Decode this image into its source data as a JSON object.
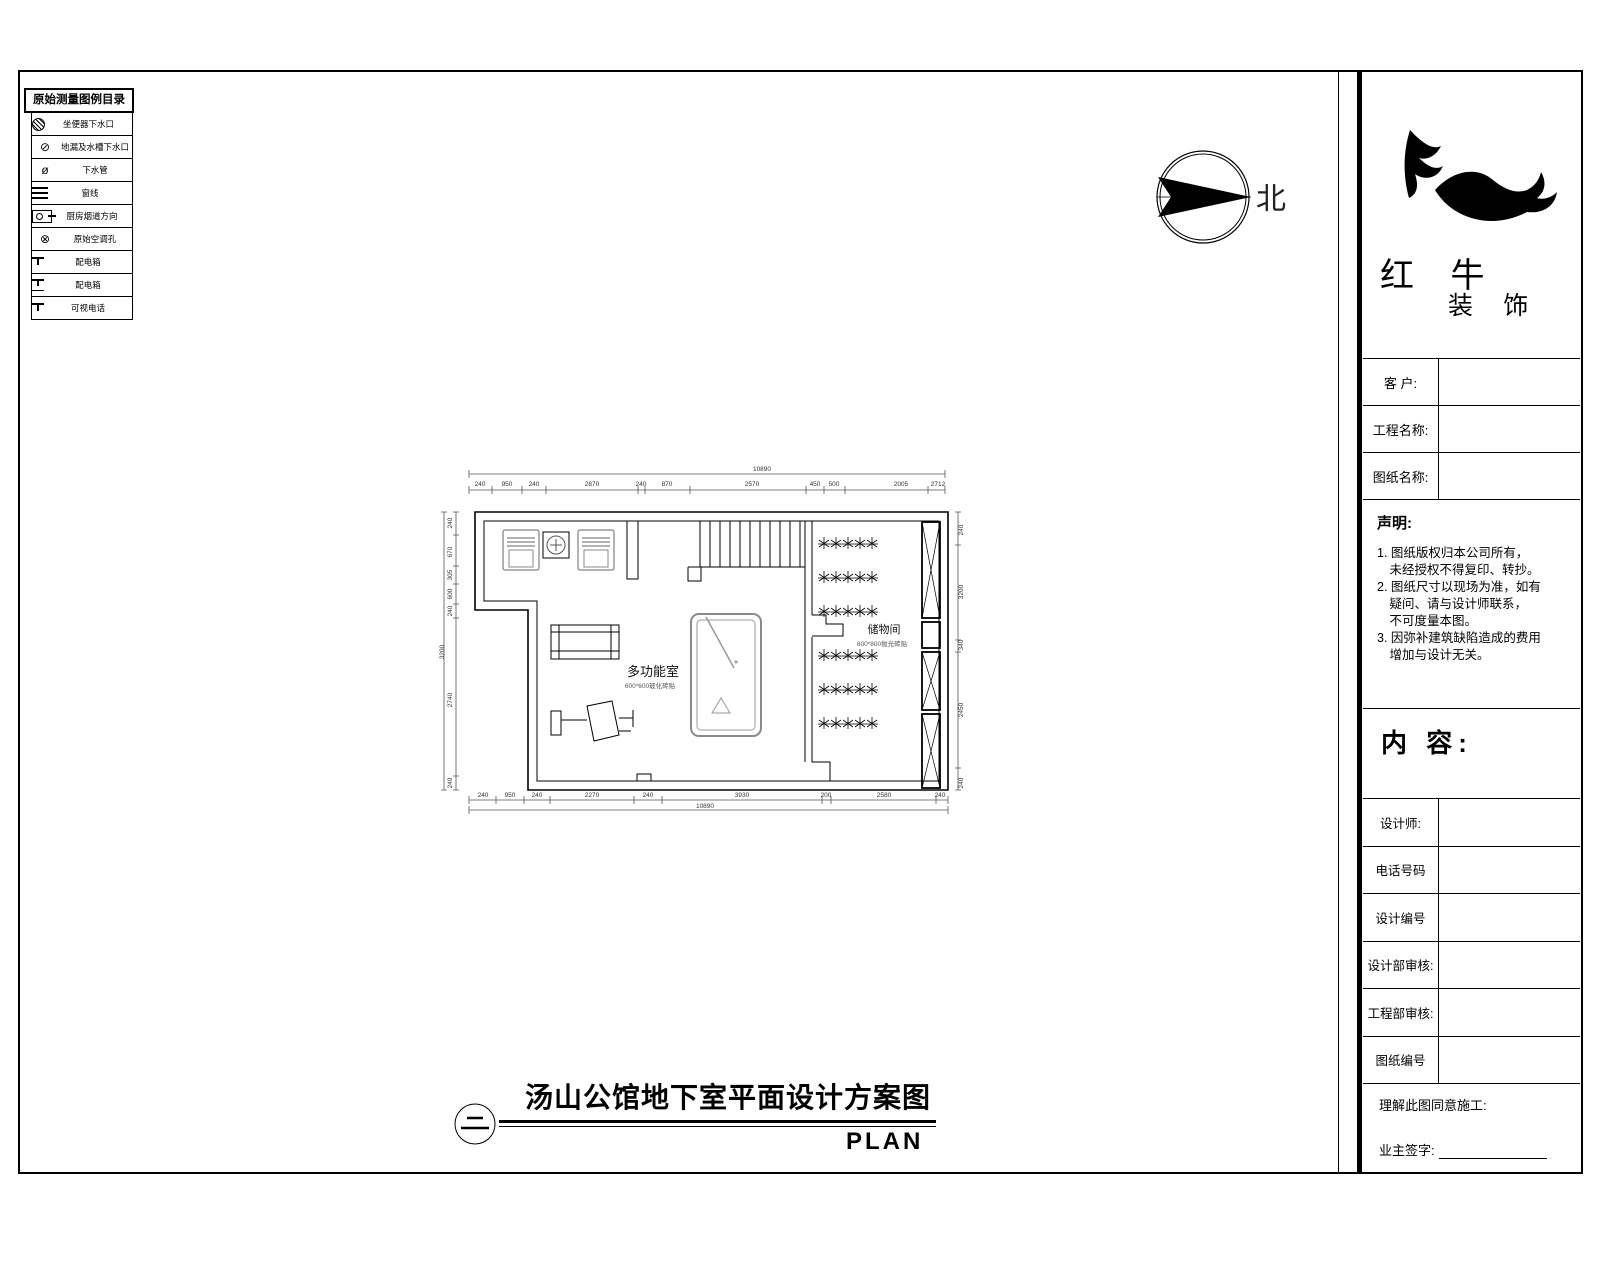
{
  "legend": {
    "title": "原始测量图例目录",
    "items": [
      {
        "icon": "toilet-drain-icon",
        "cls": "ic-circle-hatch",
        "glyph": "",
        "label": "坐便器下水口"
      },
      {
        "icon": "floor-drain-icon",
        "cls": "",
        "glyph": "⊘",
        "label": "地漏及水槽下水口"
      },
      {
        "icon": "drain-pipe-icon",
        "cls": "",
        "glyph": "ø",
        "label": "下水管"
      },
      {
        "icon": "window-line-icon",
        "cls": "ic-lines",
        "glyph": "",
        "label": "窗线"
      },
      {
        "icon": "kitchen-flue-icon",
        "cls": "ic-flue",
        "glyph": "",
        "label": "厨房烟道方向"
      },
      {
        "icon": "ac-hole-icon",
        "cls": "",
        "glyph": "⊗",
        "label": "原始空调孔"
      },
      {
        "icon": "power-box-icon",
        "cls": "ic-t",
        "glyph": "",
        "label": "配电箱"
      },
      {
        "icon": "power-box2-icon",
        "cls": "ic-t2",
        "glyph": "",
        "label": "配电箱"
      },
      {
        "icon": "video-phone-icon",
        "cls": "ic-t",
        "glyph": "",
        "label": "可视电话"
      }
    ]
  },
  "north": {
    "label": "北"
  },
  "brand": {
    "name_large": "红 牛",
    "name_small": "装 饰"
  },
  "titleblock": {
    "fields": [
      {
        "label": "客 户:",
        "value": ""
      },
      {
        "label": "工程名称:",
        "value": ""
      },
      {
        "label": "图纸名称:",
        "value": ""
      }
    ],
    "statement": {
      "title": "声明:",
      "lines": [
        "1. 图纸版权归本公司所有，",
        "　未经授权不得复印、转抄。",
        "2. 图纸尺寸以现场为准，如有",
        "　疑问、请与设计师联系，",
        "　不可度量本图。",
        "3. 因弥补建筑缺陷造成的费用",
        "　增加与设计无关。"
      ]
    },
    "content_label": "内 容:",
    "rows": [
      {
        "label": "设计师:",
        "value": ""
      },
      {
        "label": "电话号码",
        "value": ""
      },
      {
        "label": "设计编号",
        "value": ""
      },
      {
        "label": "设计部审核:",
        "value": ""
      },
      {
        "label": "工程部审核:",
        "value": ""
      },
      {
        "label": "图纸编号",
        "value": ""
      }
    ],
    "footer": {
      "line1": "理解此图同意施工:",
      "line2": "业主签字:"
    }
  },
  "plan": {
    "rooms": [
      {
        "name": "多功能室",
        "note": "600*600玻化砖贴"
      },
      {
        "name": "储物间",
        "note": "800*800抛光砖贴"
      }
    ],
    "dims": {
      "top_total": "10890",
      "bottom_total": "10890",
      "top": [
        {
          "t": "240",
          "x": 480
        },
        {
          "t": "950",
          "x": 507
        },
        {
          "t": "240",
          "x": 534
        },
        {
          "t": "2870",
          "x": 592
        },
        {
          "t": "240",
          "x": 641
        },
        {
          "t": "870",
          "x": 667
        },
        {
          "t": "2570",
          "x": 752
        },
        {
          "t": "450",
          "x": 815
        },
        {
          "t": "500",
          "x": 834
        },
        {
          "t": "2005",
          "x": 901
        },
        {
          "t": "2712",
          "x": 938
        }
      ],
      "bottom": [
        {
          "t": "240",
          "x": 483
        },
        {
          "t": "950",
          "x": 510
        },
        {
          "t": "240",
          "x": 537
        },
        {
          "t": "2270",
          "x": 592
        },
        {
          "t": "240",
          "x": 648
        },
        {
          "t": "3930",
          "x": 742
        },
        {
          "t": "200",
          "x": 826
        },
        {
          "t": "2580",
          "x": 884
        },
        {
          "t": "240",
          "x": 940
        }
      ],
      "left": [
        {
          "t": "240",
          "y": 523
        },
        {
          "t": "670",
          "y": 552
        },
        {
          "t": "305",
          "y": 575
        },
        {
          "t": "600",
          "y": 594
        },
        {
          "t": "240",
          "y": 611
        },
        {
          "t": "3200",
          "x": 444,
          "y": 652
        },
        {
          "t": "2740",
          "y": 700
        },
        {
          "t": "240",
          "y": 783
        }
      ],
      "right": [
        {
          "t": "240",
          "y": 530
        },
        {
          "t": "3200",
          "y": 592
        },
        {
          "t": "340",
          "y": 645
        },
        {
          "t": "2450",
          "y": 710
        },
        {
          "t": "240",
          "y": 783
        }
      ]
    }
  },
  "caption": {
    "index": "二",
    "title": "汤山公馆地下室平面设计方案图",
    "subtitle": "PLAN"
  }
}
